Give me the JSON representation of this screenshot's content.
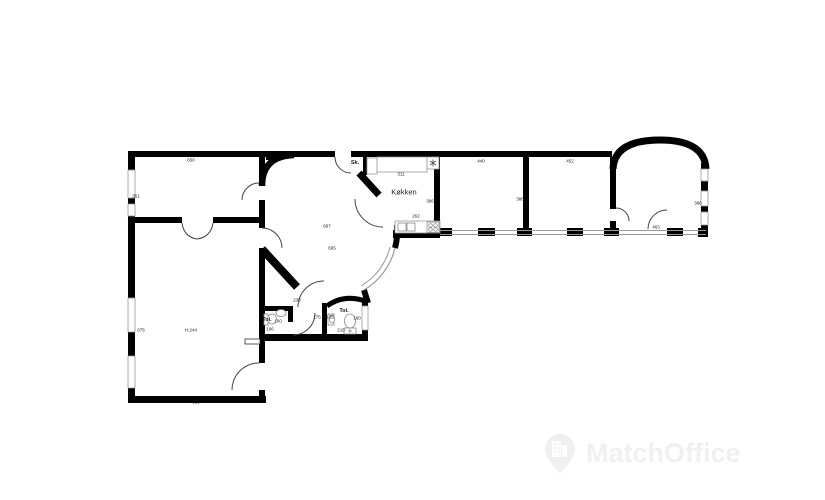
{
  "plan": {
    "left_wing": {
      "top_room": {
        "width": "650",
        "depth": "351"
      },
      "large_room": {
        "depth": "875",
        "ceiling_height": "H:244",
        "width": "650"
      }
    },
    "center": {
      "round_room": {
        "dim_a": "667",
        "dim_b": "665"
      },
      "closet_label": "Sk.",
      "kitchen": {
        "label": "Køkken",
        "counter_top": "311",
        "counter_bottom": "262",
        "depth": "386"
      },
      "hallway_width": "238",
      "toilet_left": {
        "label": "Toi.",
        "width": "100",
        "depth": "106"
      },
      "toilet_right": {
        "label": "Toi.",
        "a": "175",
        "b": "135",
        "c": "160",
        "d": "210"
      }
    },
    "right_wing": {
      "room_a": {
        "width": "440",
        "depth": "386"
      },
      "room_b": {
        "width": "452"
      },
      "tower_room": {
        "depth": "386",
        "door_width": "463"
      }
    }
  },
  "watermark": {
    "brand": "MatchOffice"
  },
  "icons": {
    "freezer": "asterisk-star",
    "watermark_logo": "map-pin-building"
  },
  "colors": {
    "wall": "#000000",
    "thin_line": "#999999",
    "fixture_line": "#888888",
    "text": "#1a1a1a",
    "watermark": "#f0f0f0",
    "background": "#ffffff"
  }
}
